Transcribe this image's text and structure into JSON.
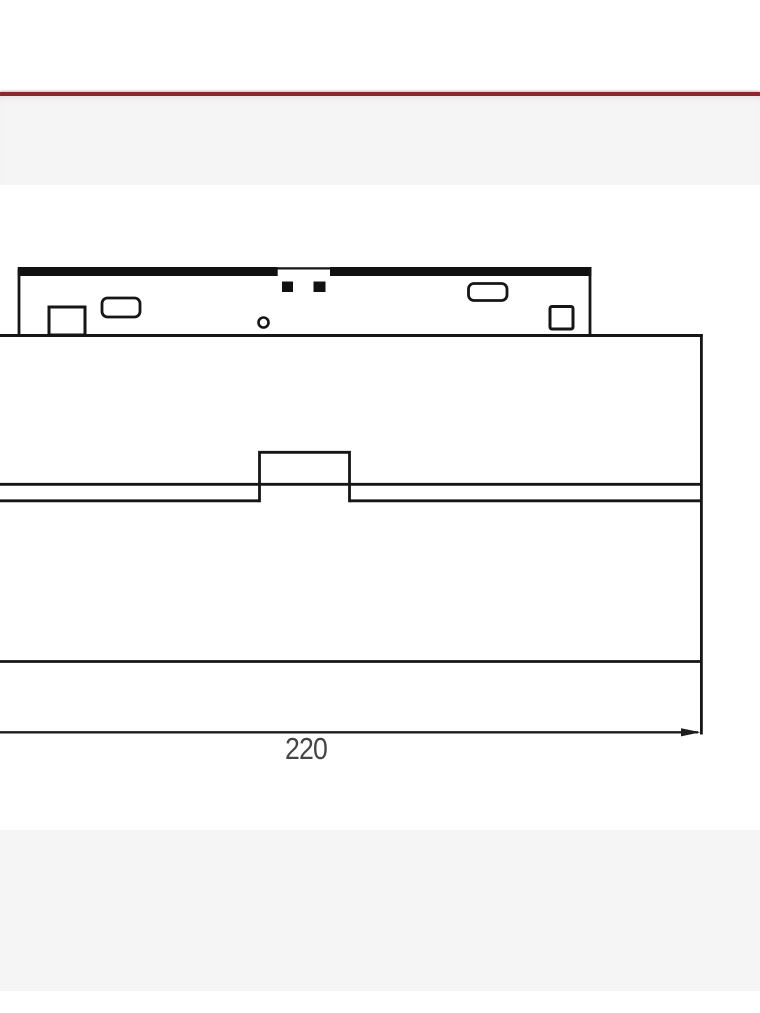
{
  "page": {
    "background_color": "#ffffff",
    "divider_color": "#8e272b",
    "band_color": "#f5f5f6"
  },
  "drawing": {
    "kind": "technical-front-elevation",
    "line_color": "#161616",
    "dimension": {
      "label": "220",
      "text_color": "#454545"
    }
  }
}
